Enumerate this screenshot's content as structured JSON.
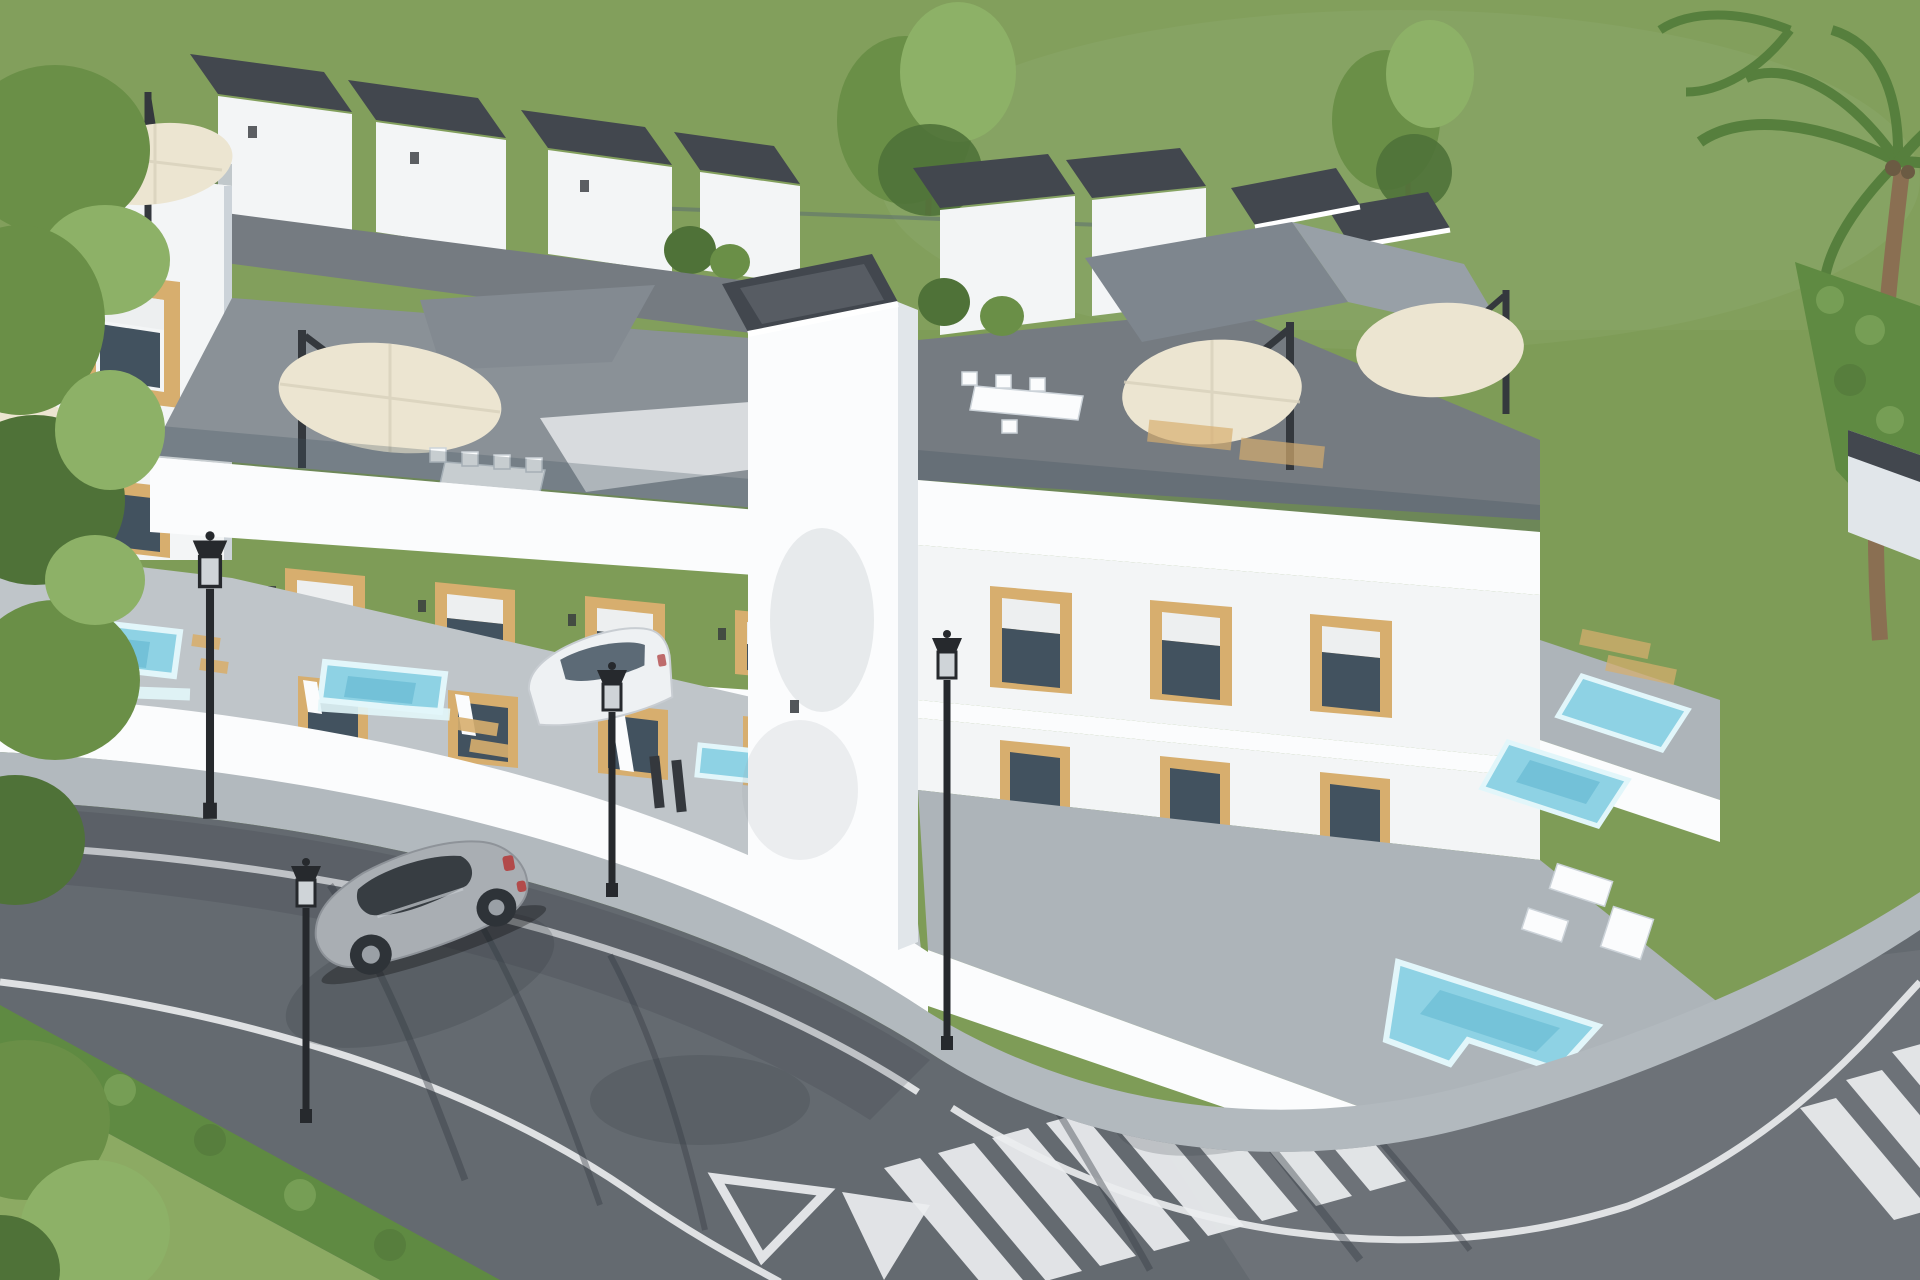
{
  "scene": {
    "description": "Aerial 3D architectural rendering of a modern white townhouse complex with rooftop terraces, cream cantilever parasols, dark gravel roof caps, wood-clad window surrounds, private patios with small turquoise pools, glass balustrades, a gray asphalt street with white lane lines, zebra crosswalks and yield road markings, a silver sports car driving by, a white car parked in a driveway, black street lamps, green lawn, leafy trees, a trimmed hedge and a palm tree.",
    "objects": {
      "townhouse_units_visible": 9,
      "plunge_pools": 6,
      "parasols": 5,
      "street_lamps": 4,
      "cars": 2,
      "crosswalks": 2,
      "yield_markings": 2
    }
  },
  "palette": {
    "grass": "#7e9c57",
    "grassLight": "#8caa63",
    "tree": "#6a8f47",
    "treeLight": "#8db167",
    "treeDark": "#4f7238",
    "palmGreen": "#567f3d",
    "trunkBrown": "#8a6f52",
    "hedge": "#5f8a42",
    "white": "#f3f5f6",
    "whiteBright": "#fbfcfd",
    "whiteShade": "#e1e6ea",
    "whiteShade2": "#ccd3d9",
    "wood": "#d7ae6e",
    "woodDark": "#b98f52",
    "glass": "#42525f",
    "shutter": "#edeff0",
    "deckDark": "#757b81",
    "deckMid": "#8a9197",
    "tileLight": "#bfc5c9",
    "tileMid": "#adb4b9",
    "roofCap": "#42474e",
    "roofCapLight": "#7d848d",
    "awningGray": "#848b92",
    "awningLight": "#d8dbde",
    "umbrellaCream": "#ece5d1",
    "poleDark": "#34383d",
    "poolBlue": "#8ed2e4",
    "poolDeep": "#60b6d0",
    "poolRim": "#e2f6fa",
    "road": "#646a70",
    "sidewalk": "#b2b9be",
    "marking": "#eceef0",
    "carSilver": "#a9aeb3",
    "carGlass": "#2e3338",
    "tailRed": "#b24a4a",
    "carWhite": "#eef1f3",
    "lampBlack": "#26292d",
    "shadowDark": "#343a42"
  }
}
